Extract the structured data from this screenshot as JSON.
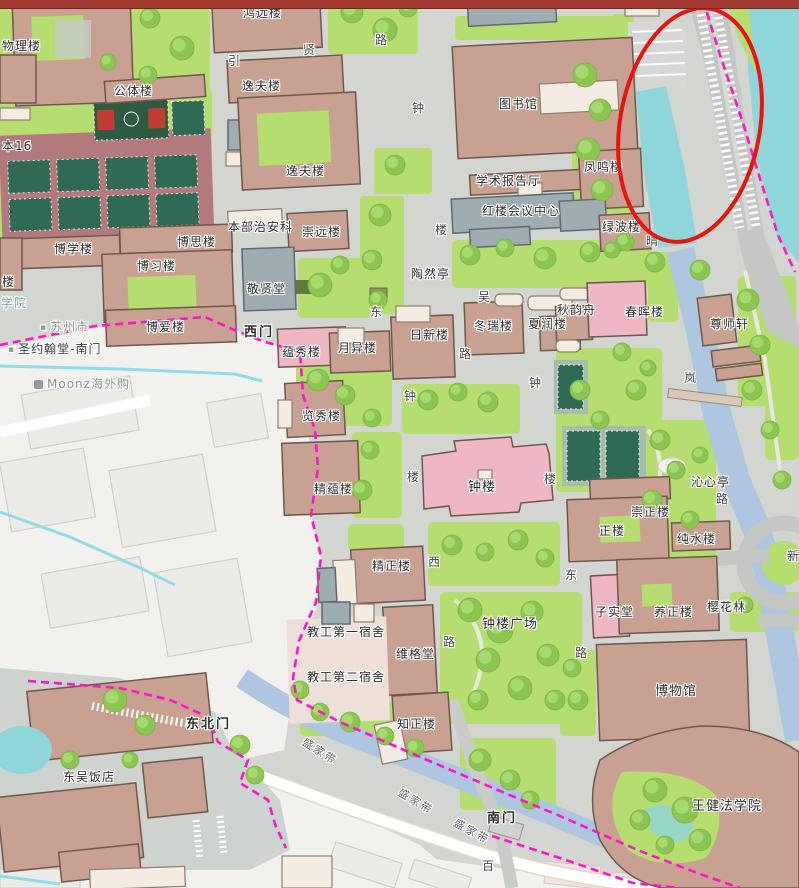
{
  "chrome": {
    "top_bar_color": "#a33a31"
  },
  "colors": {
    "campus_ground": "#d2d5d0",
    "lawn": "#b6dd70",
    "tree": "#8cc552",
    "tree_highlight": "#a7da6e",
    "building_tan": "#c9a192",
    "building_outline": "#6e574d",
    "building_pink": "#efb7c3",
    "building_gray": "#9fadb2",
    "building_white": "#f4ebe2",
    "water_teal": "#8fd5da",
    "water_canal": "#aec6e0",
    "outside_area": "#f3f1ee",
    "outside_building": "#edebe7",
    "road_major": "#c4c7c3",
    "court_green": "#2f6a55",
    "sports_field_red": "#b37a7e",
    "boundary_magenta": "#ff14c8",
    "stream_cyan": "#8edce8",
    "annotation_red": "#e8140f",
    "label_dark": "#2e2e2e",
    "label_gray": "#8f8f8f",
    "label_blue": "#7da0c0",
    "plaza_beige": "#eee0d8"
  },
  "annotation": {
    "shape": "ellipse",
    "cx": 690,
    "cy": 125,
    "rx": 70,
    "ry": 118,
    "rotation": 10,
    "color": "#e8140f",
    "stroke_width": 4
  },
  "map": {
    "building_labels": [
      {
        "text": "物理楼",
        "x": 2,
        "y": 40
      },
      {
        "text": "鸿远楼",
        "x": 243,
        "y": 7
      },
      {
        "text": "公体楼",
        "x": 114,
        "y": 85
      },
      {
        "text": "逸夫楼",
        "x": 242,
        "y": 80
      },
      {
        "text": "逸夫楼",
        "x": 286,
        "y": 165
      },
      {
        "text": "本16",
        "x": 2,
        "y": 140
      },
      {
        "text": "图书馆",
        "x": 499,
        "y": 98
      },
      {
        "text": "学术报告厅",
        "x": 476,
        "y": 175
      },
      {
        "text": "凤鸣楼",
        "x": 584,
        "y": 161
      },
      {
        "text": "红楼会议中心",
        "x": 482,
        "y": 205
      },
      {
        "text": "绿波楼",
        "x": 602,
        "y": 221
      },
      {
        "text": "本部治安科",
        "x": 228,
        "y": 221
      },
      {
        "text": "崇远楼",
        "x": 302,
        "y": 226
      },
      {
        "text": "敬贤堂",
        "x": 247,
        "y": 283
      },
      {
        "text": "博学楼",
        "x": 54,
        "y": 243
      },
      {
        "text": "博思楼",
        "x": 177,
        "y": 236
      },
      {
        "text": "博习楼",
        "x": 137,
        "y": 260
      },
      {
        "text": "博爱楼",
        "x": 146,
        "y": 321
      },
      {
        "text": "陶然亭",
        "x": 411,
        "y": 268
      },
      {
        "text": "蕴秀楼",
        "x": 282,
        "y": 346
      },
      {
        "text": "月异楼",
        "x": 338,
        "y": 342
      },
      {
        "text": "日新楼",
        "x": 410,
        "y": 329
      },
      {
        "text": "冬瑞楼",
        "x": 474,
        "y": 320
      },
      {
        "text": "夏润楼",
        "x": 528,
        "y": 318
      },
      {
        "text": "秋韵舟",
        "x": 557,
        "y": 304
      },
      {
        "text": "春晖楼",
        "x": 625,
        "y": 306
      },
      {
        "text": "尊师轩",
        "x": 710,
        "y": 318
      },
      {
        "text": "览秀楼",
        "x": 302,
        "y": 410
      },
      {
        "text": "精蕴楼",
        "x": 314,
        "y": 483
      },
      {
        "text": "钟楼",
        "x": 468,
        "y": 481,
        "s": 13
      },
      {
        "text": "沁心亭",
        "x": 691,
        "y": 476
      },
      {
        "text": "崇正楼",
        "x": 631,
        "y": 506
      },
      {
        "text": "正楼",
        "x": 599,
        "y": 525
      },
      {
        "text": "纯水楼",
        "x": 677,
        "y": 533
      },
      {
        "text": "子实堂",
        "x": 595,
        "y": 606
      },
      {
        "text": "养正楼",
        "x": 654,
        "y": 606
      },
      {
        "text": "樱花林",
        "x": 707,
        "y": 601
      },
      {
        "text": "精正楼",
        "x": 372,
        "y": 560
      },
      {
        "text": "钟楼广场",
        "x": 482,
        "y": 618,
        "s": 13
      },
      {
        "text": "教工第一宿舍",
        "x": 307,
        "y": 626
      },
      {
        "text": "维格堂",
        "x": 396,
        "y": 648
      },
      {
        "text": "教工第二宿舍",
        "x": 307,
        "y": 671
      },
      {
        "text": "知正楼",
        "x": 397,
        "y": 718
      },
      {
        "text": "博物馆",
        "x": 655,
        "y": 685,
        "s": 13
      },
      {
        "text": "王健法学院",
        "x": 692,
        "y": 800,
        "s": 13
      },
      {
        "text": "东吴饭店",
        "x": 63,
        "y": 771
      },
      {
        "text": "楼",
        "x": 2,
        "y": 276
      }
    ],
    "gate_labels": [
      {
        "text": "西门",
        "x": 244,
        "y": 326
      },
      {
        "text": "东北门",
        "x": 186,
        "y": 718
      },
      {
        "text": "南门",
        "x": 487,
        "y": 812
      }
    ],
    "road_chars": [
      {
        "text": "引",
        "x": 228,
        "y": 55
      },
      {
        "text": "贤",
        "x": 303,
        "y": 44
      },
      {
        "text": "路",
        "x": 375,
        "y": 34
      },
      {
        "text": "钟",
        "x": 412,
        "y": 102
      },
      {
        "text": "楼",
        "x": 435,
        "y": 224
      },
      {
        "text": "东",
        "x": 370,
        "y": 306
      },
      {
        "text": "吴",
        "x": 478,
        "y": 291
      },
      {
        "text": "路",
        "x": 459,
        "y": 348
      },
      {
        "text": "钟",
        "x": 404,
        "y": 390
      },
      {
        "text": "钟",
        "x": 529,
        "y": 377
      },
      {
        "text": "楼",
        "x": 407,
        "y": 471
      },
      {
        "text": "楼",
        "x": 544,
        "y": 473
      },
      {
        "text": "西",
        "x": 428,
        "y": 556
      },
      {
        "text": "东",
        "x": 565,
        "y": 569
      },
      {
        "text": "路",
        "x": 443,
        "y": 636
      },
      {
        "text": "路",
        "x": 575,
        "y": 647
      },
      {
        "text": "晴",
        "x": 646,
        "y": 235
      },
      {
        "text": "岚",
        "x": 684,
        "y": 372
      },
      {
        "text": "路",
        "x": 716,
        "y": 493
      },
      {
        "text": "百",
        "x": 482,
        "y": 860
      },
      {
        "text": "新",
        "x": 787,
        "y": 550
      }
    ],
    "street_labels": [
      {
        "text": "盛家带",
        "x": 300,
        "y": 746,
        "rot": 33
      },
      {
        "text": "盛家带",
        "x": 396,
        "y": 796,
        "rot": 31
      },
      {
        "text": "盛家带",
        "x": 452,
        "y": 826,
        "rot": 29
      }
    ],
    "poi_labels": [
      {
        "text": "苏州市",
        "x": 40,
        "y": 321,
        "cls": "poi-gray",
        "marker": true
      },
      {
        "text": "圣约翰堂-南门",
        "x": 8,
        "y": 343,
        "cls": "poi-dark",
        "marker": true
      },
      {
        "text": "育学院",
        "x": -12,
        "y": 297,
        "cls": "poi-blue"
      },
      {
        "text": "Moonz海外购",
        "x": 34,
        "y": 378,
        "cls": "poi-gray",
        "icon": "shop"
      }
    ]
  }
}
